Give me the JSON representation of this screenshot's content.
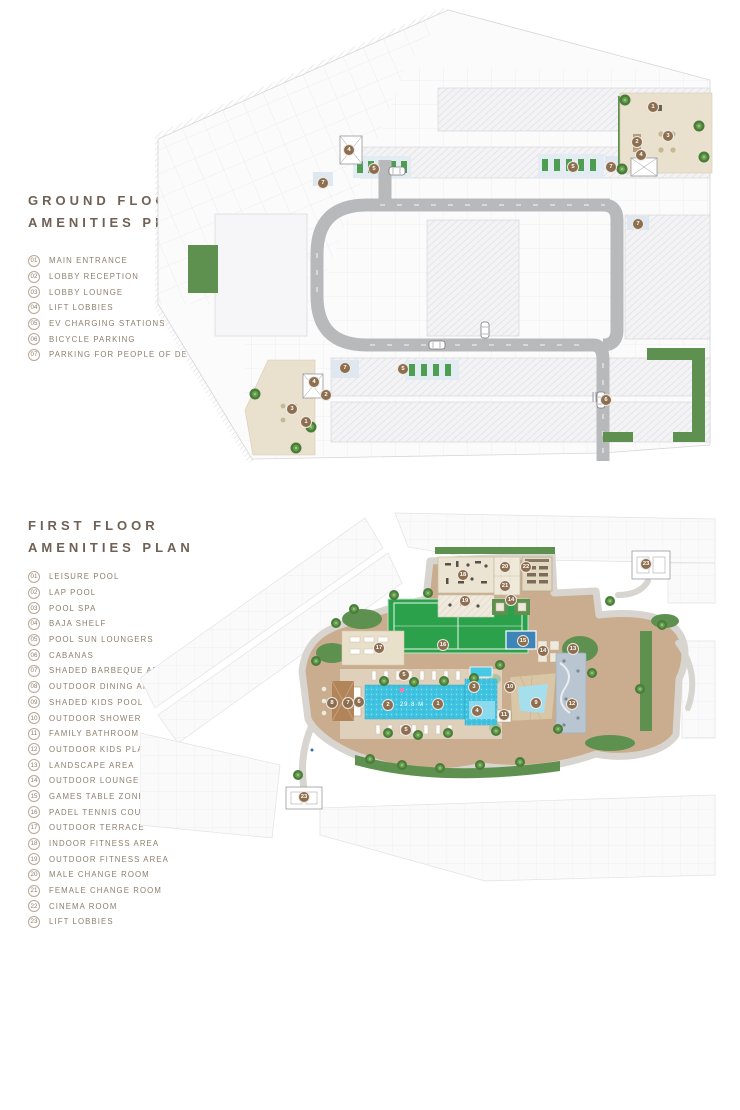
{
  "page": {
    "background": "#ffffff"
  },
  "colors": {
    "marker_brown": "#8d6f4f",
    "title_text": "#6f6155",
    "legend_text": "#8d7e6c",
    "road_gray": "#b8b9bb",
    "landscape_green": "#5e9150",
    "deck_tan": "#c9ad8e",
    "pool_blue": "#3fc3e1",
    "padel_court_green": "#2ba14b",
    "lobby_beige": "#e9e0cd"
  },
  "ground_floor": {
    "title_line1": "GROUND FLOOR",
    "title_line2": "AMENITIES PLAN",
    "legend": [
      {
        "num": "01",
        "label": "MAIN ENTRANCE"
      },
      {
        "num": "02",
        "label": "LOBBY RECEPTION"
      },
      {
        "num": "03",
        "label": "LOBBY LOUNGE"
      },
      {
        "num": "04",
        "label": "LIFT LOBBIES"
      },
      {
        "num": "05",
        "label": "EV CHARGING STATIONS"
      },
      {
        "num": "06",
        "label": "BICYCLE PARKING"
      },
      {
        "num": "07",
        "label": "PARKING FOR PEOPLE OF DETERMINATION"
      }
    ],
    "markers": [
      {
        "n": "7",
        "x": 168,
        "y": 175
      },
      {
        "n": "4",
        "x": 194,
        "y": 142
      },
      {
        "n": "5",
        "x": 219,
        "y": 161
      },
      {
        "n": "5",
        "x": 418,
        "y": 159
      },
      {
        "n": "7",
        "x": 456,
        "y": 159
      },
      {
        "n": "1",
        "x": 498,
        "y": 99
      },
      {
        "n": "2",
        "x": 482,
        "y": 134
      },
      {
        "n": "3",
        "x": 513,
        "y": 128
      },
      {
        "n": "4",
        "x": 486,
        "y": 147
      },
      {
        "n": "7",
        "x": 483,
        "y": 216
      },
      {
        "n": "6",
        "x": 451,
        "y": 392
      },
      {
        "n": "7",
        "x": 190,
        "y": 360
      },
      {
        "n": "5",
        "x": 248,
        "y": 361
      },
      {
        "n": "4",
        "x": 159,
        "y": 374
      },
      {
        "n": "2",
        "x": 171,
        "y": 387
      },
      {
        "n": "3",
        "x": 137,
        "y": 401
      },
      {
        "n": "1",
        "x": 151,
        "y": 414
      }
    ]
  },
  "first_floor": {
    "title_line1": "FIRST FLOOR",
    "title_line2": "AMENITIES PLAN",
    "pool_label": "29.8 M",
    "legend": [
      {
        "num": "01",
        "label": "LEISURE POOL"
      },
      {
        "num": "02",
        "label": "LAP POOL"
      },
      {
        "num": "03",
        "label": "POOL SPA"
      },
      {
        "num": "04",
        "label": "BAJA SHELF"
      },
      {
        "num": "05",
        "label": "POOL SUN LOUNGERS"
      },
      {
        "num": "06",
        "label": "CABANAS"
      },
      {
        "num": "07",
        "label": "SHADED BARBEQUE AREA"
      },
      {
        "num": "08",
        "label": "OUTDOOR DINING AREA"
      },
      {
        "num": "09",
        "label": "SHADED KIDS POOL"
      },
      {
        "num": "10",
        "label": "OUTDOOR SHOWER"
      },
      {
        "num": "11",
        "label": "FAMILY BATHROOM"
      },
      {
        "num": "12",
        "label": "OUTDOOR KIDS PLAY AREA"
      },
      {
        "num": "13",
        "label": "LANDSCAPE AREA"
      },
      {
        "num": "14",
        "label": "OUTDOOR LOUNGE AREA"
      },
      {
        "num": "15",
        "label": "GAMES TABLE ZONE"
      },
      {
        "num": "16",
        "label": "PADEL TENNIS COURT"
      },
      {
        "num": "17",
        "label": "OUTDOOR TERRACE"
      },
      {
        "num": "18",
        "label": "INDOOR FITNESS AREA"
      },
      {
        "num": "19",
        "label": "OUTDOOR FITNESS AREA"
      },
      {
        "num": "20",
        "label": "MALE CHANGE ROOM"
      },
      {
        "num": "21",
        "label": "FEMALE CHANGE ROOM"
      },
      {
        "num": "22",
        "label": "CINEMA ROOM"
      },
      {
        "num": "23",
        "label": "LIFT LOBBIES"
      }
    ],
    "markers": [
      {
        "n": "17",
        "x": 239,
        "y": 145
      },
      {
        "n": "16",
        "x": 303,
        "y": 142
      },
      {
        "n": "18",
        "x": 323,
        "y": 72
      },
      {
        "n": "19",
        "x": 325,
        "y": 98
      },
      {
        "n": "20",
        "x": 365,
        "y": 64
      },
      {
        "n": "21",
        "x": 365,
        "y": 83
      },
      {
        "n": "22",
        "x": 386,
        "y": 64
      },
      {
        "n": "23",
        "x": 506,
        "y": 61
      },
      {
        "n": "23",
        "x": 164,
        "y": 294
      },
      {
        "n": "14",
        "x": 371,
        "y": 97
      },
      {
        "n": "15",
        "x": 383,
        "y": 138
      },
      {
        "n": "14",
        "x": 403,
        "y": 148
      },
      {
        "n": "13",
        "x": 433,
        "y": 146
      },
      {
        "n": "5",
        "x": 264,
        "y": 172
      },
      {
        "n": "5",
        "x": 266,
        "y": 227
      },
      {
        "n": "2",
        "x": 248,
        "y": 202
      },
      {
        "n": "1",
        "x": 298,
        "y": 201
      },
      {
        "n": "3",
        "x": 334,
        "y": 184
      },
      {
        "n": "4",
        "x": 337,
        "y": 208
      },
      {
        "n": "6",
        "x": 219,
        "y": 199
      },
      {
        "n": "7",
        "x": 208,
        "y": 200
      },
      {
        "n": "8",
        "x": 192,
        "y": 200
      },
      {
        "n": "9",
        "x": 396,
        "y": 200
      },
      {
        "n": "10",
        "x": 370,
        "y": 184
      },
      {
        "n": "11",
        "x": 364,
        "y": 212
      },
      {
        "n": "12",
        "x": 432,
        "y": 201
      }
    ]
  }
}
